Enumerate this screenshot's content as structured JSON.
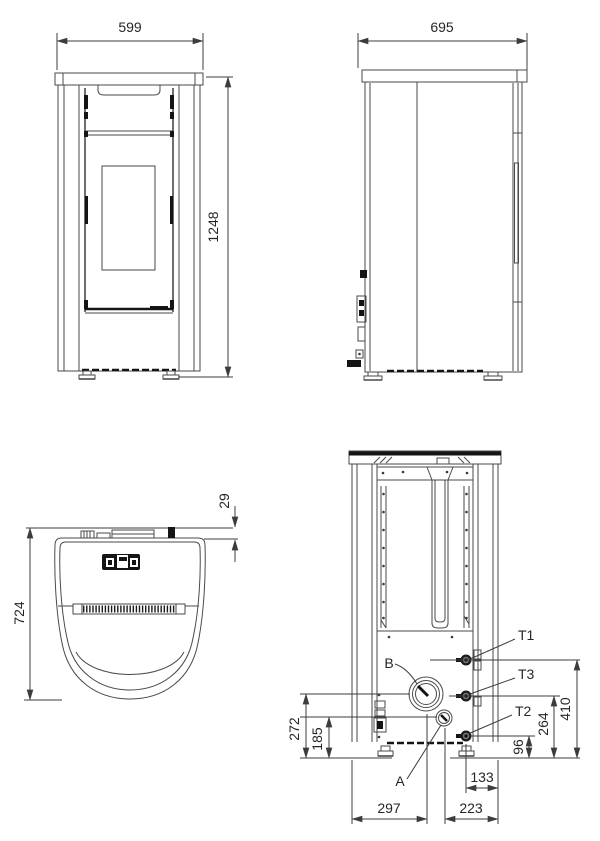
{
  "meta": {
    "type": "technical-dimension-drawing",
    "subject": "pellet stove orthographic views (front, side, top, rear)"
  },
  "views": {
    "front": {
      "title": "front-view",
      "dims": {
        "width": "599",
        "height": "1248"
      }
    },
    "side": {
      "title": "side-view",
      "dims": {
        "depth": "695"
      }
    },
    "top": {
      "title": "top-view",
      "dims": {
        "total_depth": "724",
        "rear_protrusion": "29"
      }
    },
    "rear": {
      "title": "rear-view",
      "labels": {
        "t1": "T1",
        "t3": "T3",
        "t2": "T2",
        "a": "A",
        "b": "B"
      },
      "dims": {
        "b_height": "272",
        "a_height": "185",
        "t1_height": "410",
        "t3_height": "264",
        "t2_height": "96",
        "t_inset": "133",
        "b_from_left": "297",
        "a_from_right": "223"
      }
    }
  },
  "colors": {
    "background": "#ffffff",
    "line": "#4a4a4a",
    "dark": "#141414",
    "dimension": "#3c3c3c",
    "text": "#262626"
  }
}
